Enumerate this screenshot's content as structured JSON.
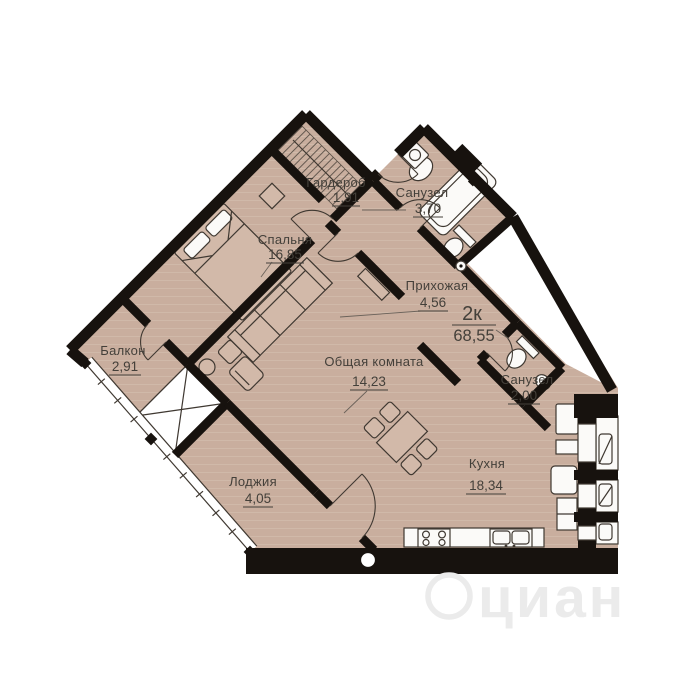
{
  "plan": {
    "unit": {
      "type": "2к",
      "area": "68,55"
    },
    "rooms": [
      {
        "name": "Гардероб",
        "area": "1,91"
      },
      {
        "name": "Санузел",
        "area": "3,70"
      },
      {
        "name": "Спальня",
        "area": "16,85"
      },
      {
        "name": "Прихожая",
        "area": "4,56"
      },
      {
        "name": "Балкон",
        "area": "2,91"
      },
      {
        "name": "Общая комната",
        "area": "14,23"
      },
      {
        "name": "Санузел",
        "area": "2,00"
      },
      {
        "name": "Лоджия",
        "area": "4,05"
      },
      {
        "name": "Кухня",
        "area": "18,34"
      }
    ],
    "watermark": "циан",
    "colors": {
      "floor": "#c9ae9e",
      "stripe": "#d6c0b0",
      "wall": "#17120e",
      "line": "#3f3831",
      "fixture": "#fbfaf8",
      "label": "#44403a",
      "watermark": "#ebebeb"
    }
  }
}
